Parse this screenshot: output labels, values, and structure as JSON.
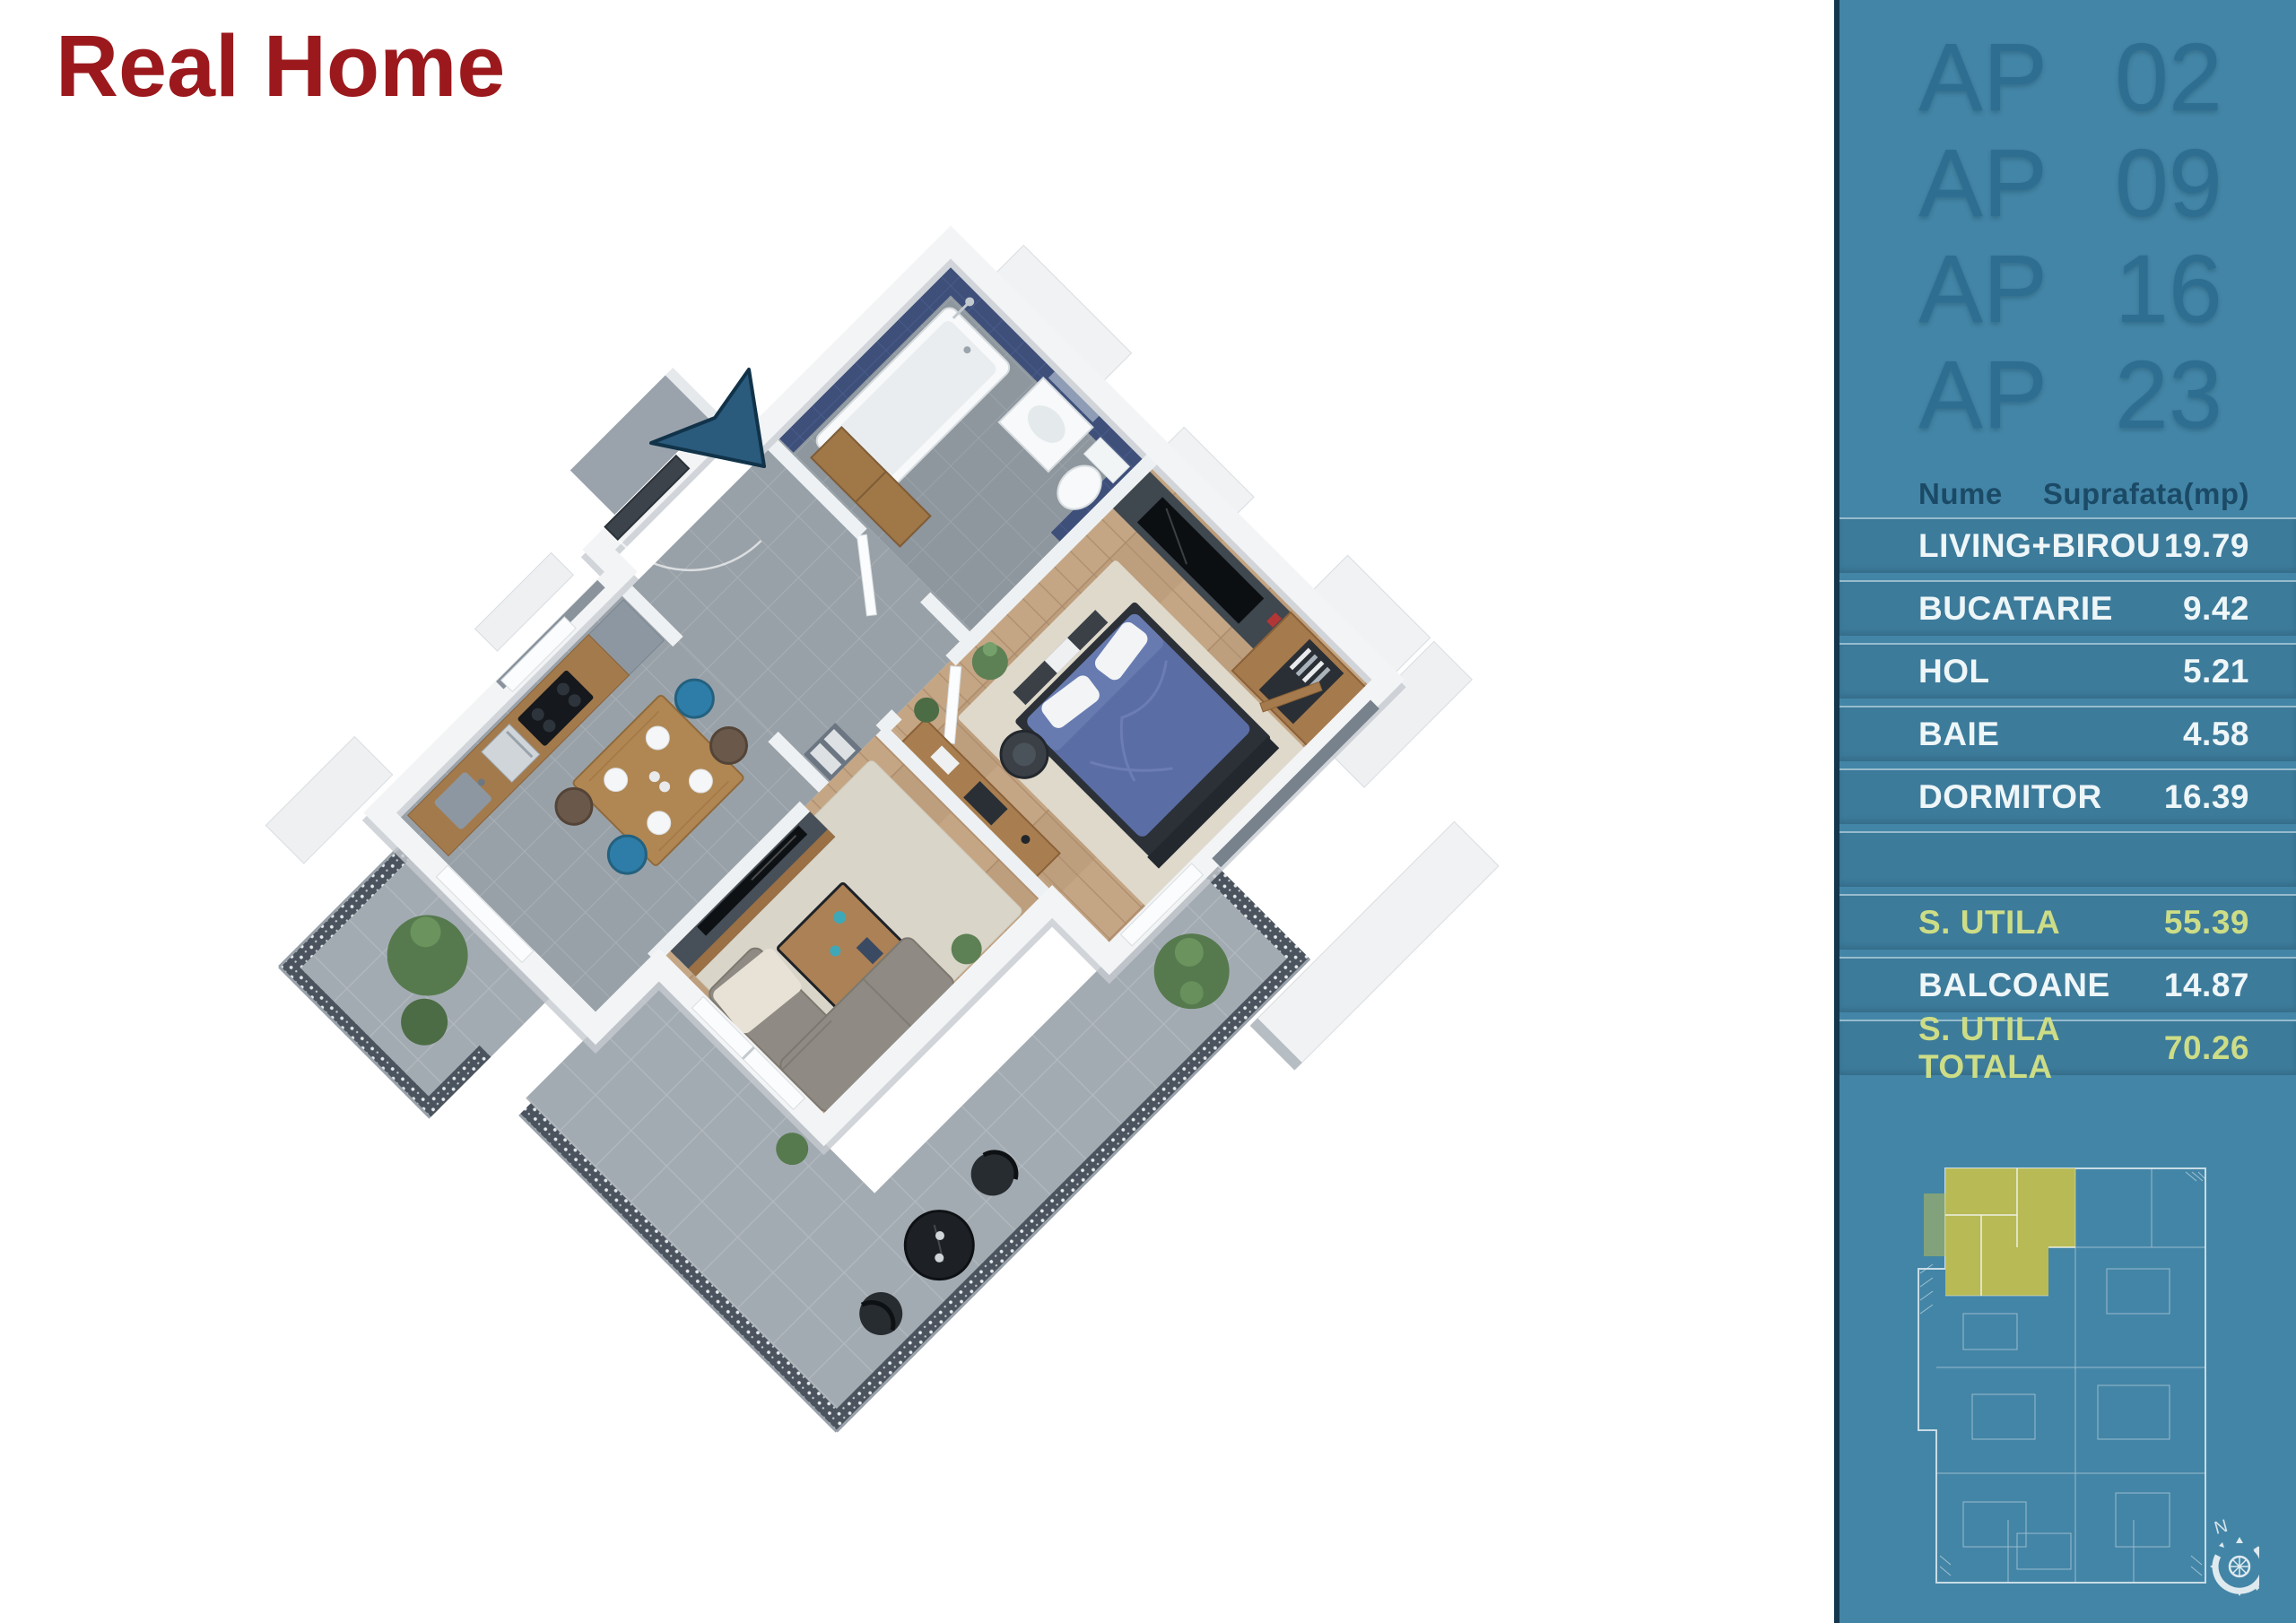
{
  "logo": {
    "text": "Real Home"
  },
  "sidebar": {
    "apartments": [
      {
        "prefix": "AP",
        "number": "02"
      },
      {
        "prefix": "AP",
        "number": "09"
      },
      {
        "prefix": "AP",
        "number": "16"
      },
      {
        "prefix": "AP",
        "number": "23"
      }
    ],
    "table": {
      "header": {
        "name": "Nume",
        "area": "Suprafata(mp)"
      },
      "rows": [
        {
          "label": "LIVING+BIROU",
          "value": "19.79"
        },
        {
          "label": "BUCATARIE",
          "value": "9.42"
        },
        {
          "label": "HOL",
          "value": "5.21"
        },
        {
          "label": "BAIE",
          "value": "4.58"
        },
        {
          "label": "DORMITOR",
          "value": "16.39"
        }
      ],
      "totals": [
        {
          "label": "S. UTILA",
          "value": "55.39",
          "highlight": true
        },
        {
          "label": "BALCOANE",
          "value": "14.87",
          "highlight": false
        },
        {
          "label": "S. UTILA TOTALA",
          "value": "70.26",
          "highlight": true
        }
      ]
    }
  },
  "floorplan": {
    "compass_label": "N",
    "rooms": [
      "bathroom",
      "hall",
      "kitchen-dining",
      "bedroom",
      "living-room",
      "terrace",
      "balcony"
    ],
    "colors": {
      "logo_red": "#9b191d",
      "sidebar_blue": "#4385a6",
      "highlight_yellow": "#cddd86",
      "blueprint_unit_yellow": "#c2bf4f",
      "entry_arrow_navy": "#2a5a7c",
      "bath_tile_navy": "#3e4f7a",
      "bed_blue": "#5b6da5"
    }
  }
}
